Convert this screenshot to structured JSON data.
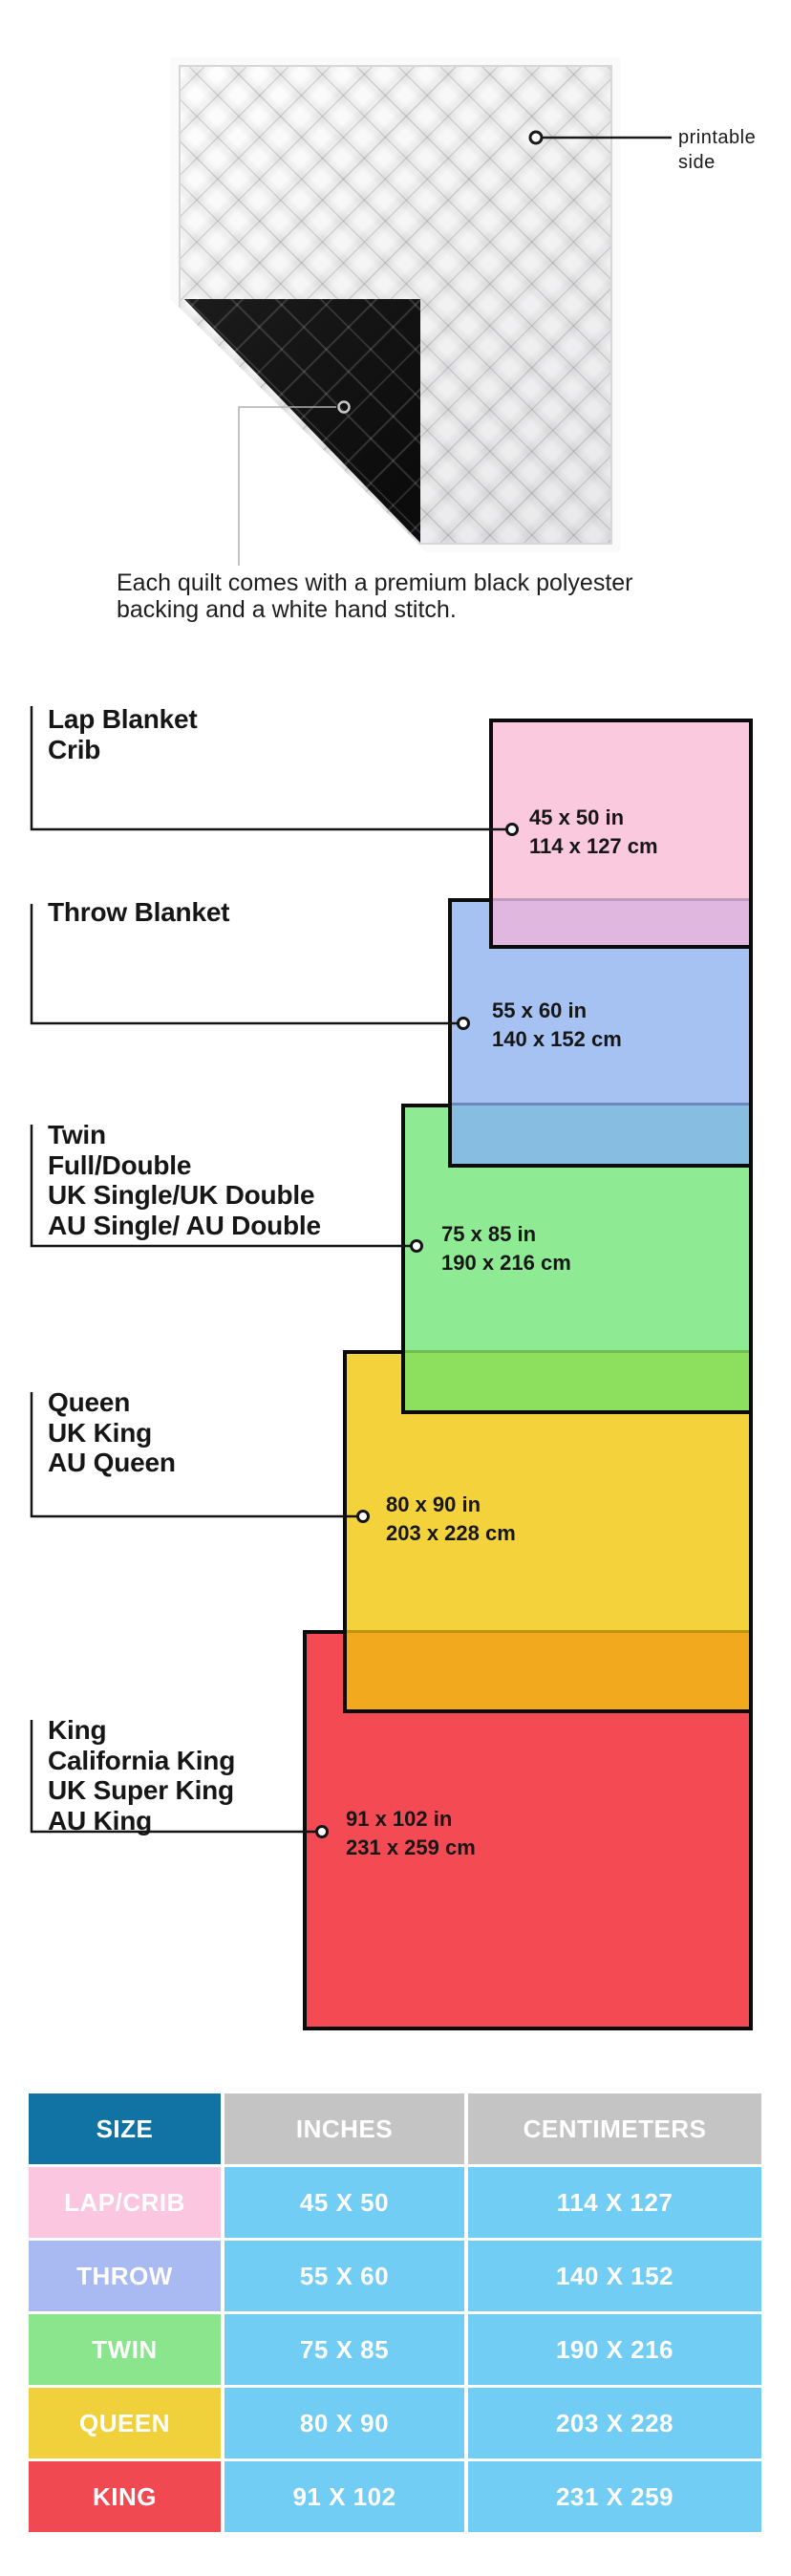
{
  "hero": {
    "printable_label": "printable side",
    "caption": "Each quilt comes with a premium black polyester backing and a white hand stitch.",
    "front_color": "#F2F2F3",
    "backing_color": "#0C0C0C"
  },
  "diagram": {
    "sizes": [
      {
        "id": "lap",
        "labels": [
          "Lap Blanket",
          "Crib"
        ],
        "inches_label": "45 x 50 in",
        "cm_label": "114 x 127 cm",
        "color": "#FBC9DE"
      },
      {
        "id": "throw",
        "labels": [
          "Throw Blanket"
        ],
        "inches_label": "55 x 60 in",
        "cm_label": "140 x 152 cm",
        "color": "#A5C2F3"
      },
      {
        "id": "twin",
        "labels": [
          "Twin",
          "Full/Double",
          "UK Single/UK Double",
          "AU Single/ AU Double"
        ],
        "inches_label": "75 x 85 in",
        "cm_label": "190 x 216 cm",
        "color": "#8FEB93"
      },
      {
        "id": "queen",
        "labels": [
          "Queen",
          "UK King",
          "AU Queen"
        ],
        "inches_label": "80 x 90 in",
        "cm_label": "203 x 228 cm",
        "color": "#F4D23C"
      },
      {
        "id": "king",
        "labels": [
          "King",
          "California King",
          "UK Super King",
          "AU King"
        ],
        "inches_label": "91 x 102 in",
        "cm_label": "231 x 259 cm",
        "color": "#F44A54"
      }
    ],
    "overlap_colors": {
      "lap_over_throw": "#E0B7DF",
      "throw_over_twin": "#86BDE0",
      "twin_over_queen": "#8DE05E",
      "queen_over_king": "#F3A91D"
    },
    "border_color": "#0B0B0B"
  },
  "table": {
    "headers": [
      "SIZE",
      "INCHES",
      "CENTIMETERS"
    ],
    "rows": [
      {
        "size": "LAP/CRIB",
        "inches": "45 X 50",
        "centimeters": "114 X 127",
        "color": "#FAC6E0"
      },
      {
        "size": "THROW",
        "inches": "55 X 60",
        "centimeters": "140 X 152",
        "color": "#A9BAF2"
      },
      {
        "size": "TWIN",
        "inches": "75 X 85",
        "centimeters": "190 X 216",
        "color": "#8BE58C"
      },
      {
        "size": "QUEEN",
        "inches": "80 X 90",
        "centimeters": "203 X 228",
        "color": "#F0D13C"
      },
      {
        "size": "KING",
        "inches": "91 X 102",
        "centimeters": "231 X 259",
        "color": "#F04952"
      }
    ],
    "header_colors": {
      "size_header": "#1173A3",
      "measure_header": "#C4C4C4",
      "value_cell": "#72CDF4"
    }
  }
}
